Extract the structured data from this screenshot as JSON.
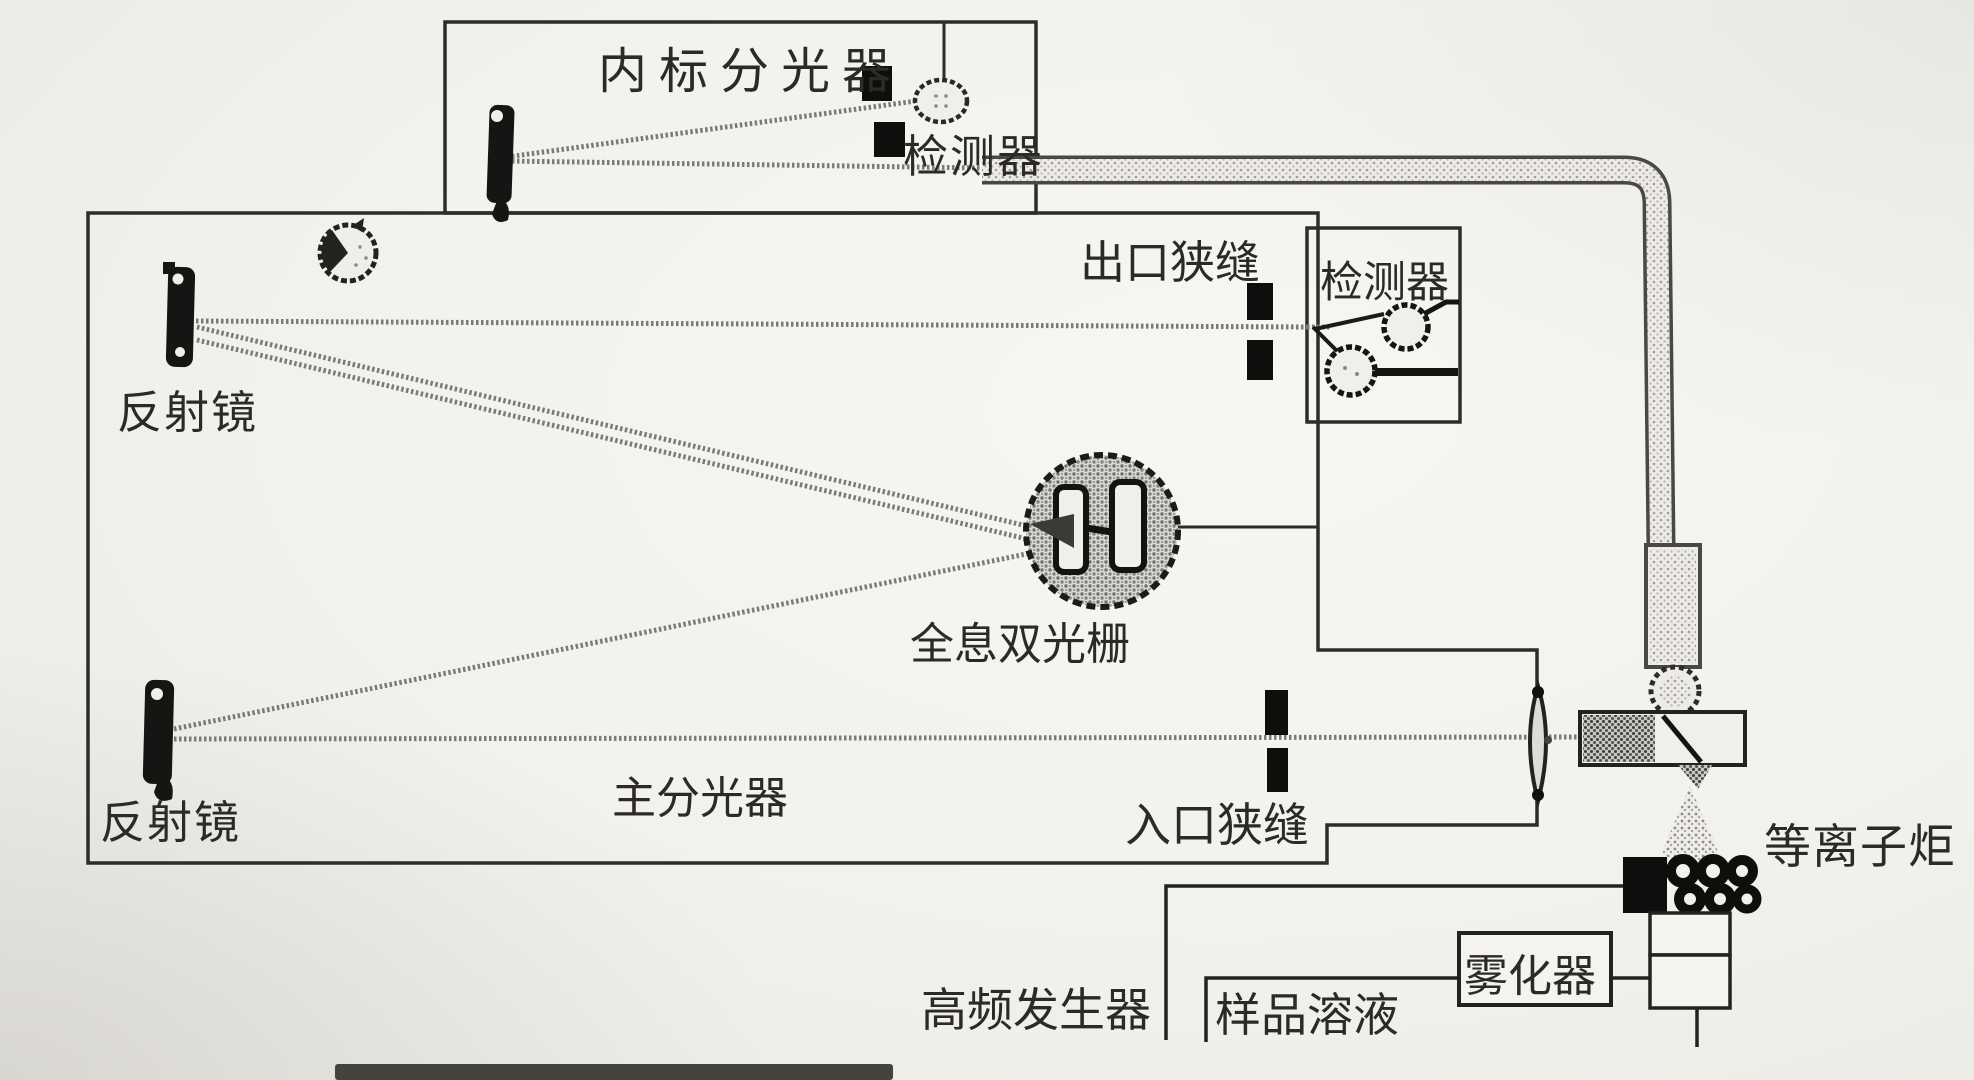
{
  "figure": {
    "type": "scanned-schematic",
    "subject": "ICP emission spectrometer optical diagram",
    "colors": {
      "paper": "#f2f1ed",
      "ink": "#2c2a27",
      "beam": "#7a7a78",
      "slit": "#0f0e0d",
      "halftone": "#8b8984"
    }
  },
  "labels": {
    "internal_spectrometer": "内标分光器",
    "internal_detector": "检测器",
    "exit_slit": "出口狭缝",
    "side_detector": "检测器",
    "mirror_upper": "反射镜",
    "grating": "全息双光栅",
    "mirror_lower": "反射镜",
    "main_spectrometer": "主分光器",
    "entrance_slit": "入口狭缝",
    "plasma_torch": "等离子炬",
    "hf_generator": "高频发生器",
    "sample_solution": "样品溶液",
    "nebulizer": "雾化器"
  }
}
